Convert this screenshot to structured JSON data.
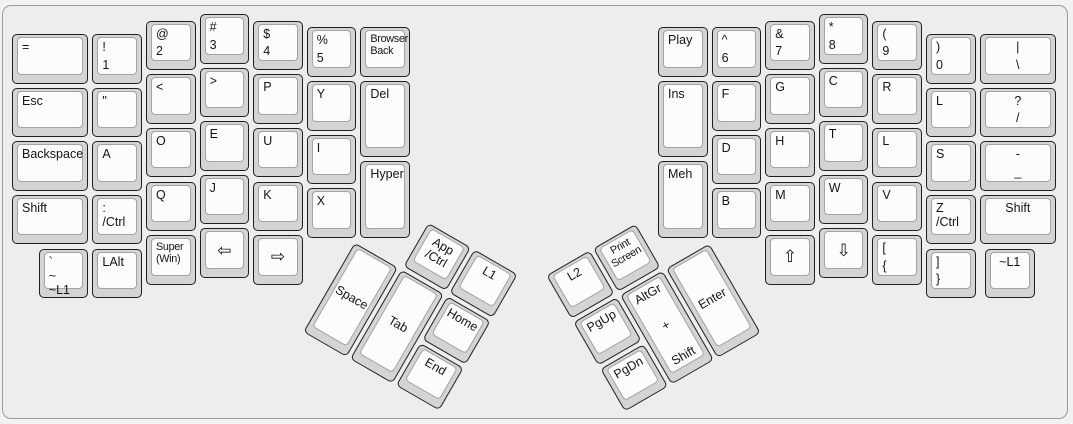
{
  "colors": {
    "page_bg": "#f2f2f2",
    "canvas_bg": "#ededed",
    "canvas_border": "#9b9b9b",
    "keycap_side": "#d4d4d4",
    "keycap_border": "#1f1f1f",
    "keycap_face": "#fcfcfc",
    "keycap_face_border": "#a3a3a3",
    "legend": "#141414"
  },
  "layout": {
    "unit": 53.6,
    "cap_inset": 2,
    "groups": {
      "left_main": {
        "origin_x": 10,
        "origin_y": 12,
        "rotation": 0,
        "keys": [
          {
            "name": "key-equals",
            "x": 0,
            "y": 0.375,
            "w": 1.5,
            "labels": [
              "="
            ]
          },
          {
            "name": "key-esc",
            "x": 0,
            "y": 1.375,
            "w": 1.5,
            "labels": [
              "Esc"
            ]
          },
          {
            "name": "key-backspace",
            "x": 0,
            "y": 2.375,
            "w": 1.5,
            "labels": [
              "Backspace"
            ]
          },
          {
            "name": "key-left-shift",
            "x": 0,
            "y": 3.375,
            "w": 1.5,
            "labels": [
              "Shift"
            ]
          },
          {
            "name": "key-1",
            "x": 1.5,
            "y": 0.375,
            "labels": [
              "!",
              "1"
            ],
            "v": "between"
          },
          {
            "name": "key-quote",
            "x": 1.5,
            "y": 1.375,
            "labels": [
              "\""
            ]
          },
          {
            "name": "key-a",
            "x": 1.5,
            "y": 2.375,
            "labels": [
              "A"
            ]
          },
          {
            "name": "key-colon-ctrl",
            "x": 1.5,
            "y": 3.375,
            "labels": [
              ":",
              "/Ctrl"
            ]
          },
          {
            "name": "key-2",
            "x": 2.5,
            "y": 0.125,
            "labels": [
              "@",
              "2"
            ],
            "v": "between"
          },
          {
            "name": "key-less-than",
            "x": 2.5,
            "y": 1.125,
            "labels": [
              "<"
            ]
          },
          {
            "name": "key-o",
            "x": 2.5,
            "y": 2.125,
            "labels": [
              "O"
            ]
          },
          {
            "name": "key-q",
            "x": 2.5,
            "y": 3.125,
            "labels": [
              "Q"
            ]
          },
          {
            "name": "key-3",
            "x": 3.5,
            "y": 0,
            "labels": [
              "#",
              "3"
            ],
            "v": "between"
          },
          {
            "name": "key-greater-than",
            "x": 3.5,
            "y": 1,
            "labels": [
              ">"
            ]
          },
          {
            "name": "key-e",
            "x": 3.5,
            "y": 2,
            "labels": [
              "E"
            ]
          },
          {
            "name": "key-j",
            "x": 3.5,
            "y": 3,
            "labels": [
              "J"
            ]
          },
          {
            "name": "key-4",
            "x": 4.5,
            "y": 0.125,
            "labels": [
              "$",
              "4"
            ],
            "v": "between"
          },
          {
            "name": "key-p",
            "x": 4.5,
            "y": 1.125,
            "labels": [
              "P"
            ]
          },
          {
            "name": "key-u",
            "x": 4.5,
            "y": 2.125,
            "labels": [
              "U"
            ]
          },
          {
            "name": "key-k",
            "x": 4.5,
            "y": 3.125,
            "labels": [
              "K"
            ]
          },
          {
            "name": "key-5",
            "x": 5.5,
            "y": 0.25,
            "labels": [
              "%",
              "5"
            ],
            "v": "between"
          },
          {
            "name": "key-y",
            "x": 5.5,
            "y": 1.25,
            "labels": [
              "Y"
            ]
          },
          {
            "name": "key-i",
            "x": 5.5,
            "y": 2.25,
            "labels": [
              "I"
            ]
          },
          {
            "name": "key-x",
            "x": 5.5,
            "y": 3.25,
            "labels": [
              "X"
            ]
          },
          {
            "name": "key-browser-back",
            "x": 6.5,
            "y": 0.25,
            "labels": [
              "Browser",
              "Back"
            ],
            "fs": "small"
          },
          {
            "name": "key-del",
            "x": 6.5,
            "y": 1.25,
            "h": 1.5,
            "labels": [
              "Del"
            ]
          },
          {
            "name": "key-hyper",
            "x": 6.5,
            "y": 2.75,
            "h": 1.5,
            "labels": [
              "Hyper"
            ]
          },
          {
            "name": "key-grave-l1",
            "x": 0.5,
            "y": 4.375,
            "labels": [
              "`",
              "~",
              "~L1"
            ],
            "v": "between"
          },
          {
            "name": "key-lalt",
            "x": 1.5,
            "y": 4.375,
            "labels": [
              "LAlt"
            ]
          },
          {
            "name": "key-super-win",
            "x": 2.5,
            "y": 4.125,
            "labels": [
              "Super",
              "(Win)"
            ],
            "fs": "small"
          },
          {
            "name": "key-arrow-left",
            "x": 3.5,
            "y": 4,
            "labels": [
              "⇦"
            ],
            "v": "mid",
            "a": "center",
            "fs": "big"
          },
          {
            "name": "key-arrow-right",
            "x": 4.5,
            "y": 4.125,
            "labels": [
              "⇨"
            ],
            "v": "mid",
            "a": "center",
            "fs": "big"
          }
        ]
      },
      "right_main": {
        "origin_x": 656,
        "origin_y": 12,
        "rotation": 0,
        "keys": [
          {
            "name": "key-play",
            "x": 0,
            "y": 0.25,
            "labels": [
              "Play"
            ]
          },
          {
            "name": "key-ins",
            "x": 0,
            "y": 1.25,
            "h": 1.5,
            "labels": [
              "Ins"
            ]
          },
          {
            "name": "key-meh",
            "x": 0,
            "y": 2.75,
            "h": 1.5,
            "labels": [
              "Meh"
            ]
          },
          {
            "name": "key-6",
            "x": 1,
            "y": 0.25,
            "labels": [
              "^",
              "6"
            ],
            "v": "between"
          },
          {
            "name": "key-f",
            "x": 1,
            "y": 1.25,
            "labels": [
              "F"
            ]
          },
          {
            "name": "key-d",
            "x": 1,
            "y": 2.25,
            "labels": [
              "D"
            ]
          },
          {
            "name": "key-b",
            "x": 1,
            "y": 3.25,
            "labels": [
              "B"
            ]
          },
          {
            "name": "key-7",
            "x": 2,
            "y": 0.125,
            "labels": [
              "&",
              "7"
            ],
            "v": "between"
          },
          {
            "name": "key-g",
            "x": 2,
            "y": 1.125,
            "labels": [
              "G"
            ]
          },
          {
            "name": "key-h",
            "x": 2,
            "y": 2.125,
            "labels": [
              "H"
            ]
          },
          {
            "name": "key-m",
            "x": 2,
            "y": 3.125,
            "labels": [
              "M"
            ]
          },
          {
            "name": "key-8",
            "x": 3,
            "y": 0,
            "labels": [
              "*",
              "8"
            ],
            "v": "between"
          },
          {
            "name": "key-c",
            "x": 3,
            "y": 1,
            "labels": [
              "C"
            ]
          },
          {
            "name": "key-t",
            "x": 3,
            "y": 2,
            "labels": [
              "T"
            ]
          },
          {
            "name": "key-w",
            "x": 3,
            "y": 3,
            "labels": [
              "W"
            ]
          },
          {
            "name": "key-9",
            "x": 4,
            "y": 0.125,
            "labels": [
              "(",
              "9"
            ],
            "v": "between"
          },
          {
            "name": "key-r",
            "x": 4,
            "y": 1.125,
            "labels": [
              "R"
            ]
          },
          {
            "name": "key-l-middle",
            "x": 4,
            "y": 2.125,
            "labels": [
              "L"
            ]
          },
          {
            "name": "key-v",
            "x": 4,
            "y": 3.125,
            "labels": [
              "V"
            ]
          },
          {
            "name": "key-0",
            "x": 5,
            "y": 0.375,
            "labels": [
              ")",
              "0"
            ],
            "v": "between"
          },
          {
            "name": "key-l-upper",
            "x": 5,
            "y": 1.375,
            "labels": [
              "L"
            ]
          },
          {
            "name": "key-s",
            "x": 5,
            "y": 2.375,
            "labels": [
              "S"
            ]
          },
          {
            "name": "key-z-ctrl",
            "x": 5,
            "y": 3.375,
            "labels": [
              "Z",
              "/Ctrl"
            ]
          },
          {
            "name": "key-pipe-backslash",
            "x": 6,
            "y": 0.375,
            "w": 1.5,
            "labels": [
              "|",
              "\\"
            ],
            "v": "between",
            "a": "center"
          },
          {
            "name": "key-question-slash",
            "x": 6,
            "y": 1.375,
            "w": 1.5,
            "labels": [
              "?",
              "/"
            ],
            "v": "between",
            "a": "center"
          },
          {
            "name": "key-minus-underscore",
            "x": 6,
            "y": 2.375,
            "w": 1.5,
            "labels": [
              "-",
              "_"
            ],
            "v": "between",
            "a": "center"
          },
          {
            "name": "key-right-shift",
            "x": 6,
            "y": 3.375,
            "w": 1.5,
            "labels": [
              "Shift"
            ],
            "a": "center"
          },
          {
            "name": "key-arrow-up",
            "x": 2,
            "y": 4.125,
            "labels": [
              "⇧"
            ],
            "v": "mid",
            "a": "center",
            "fs": "big"
          },
          {
            "name": "key-arrow-down",
            "x": 3,
            "y": 4,
            "labels": [
              "⇩"
            ],
            "v": "mid",
            "a": "center",
            "fs": "big"
          },
          {
            "name": "key-lbracket-brace",
            "x": 4,
            "y": 4.125,
            "labels": [
              "[",
              "{"
            ],
            "v": "between"
          },
          {
            "name": "key-rbracket-brace",
            "x": 5,
            "y": 4.375,
            "labels": [
              "]",
              "}"
            ],
            "v": "between"
          },
          {
            "name": "key-tilde-l1",
            "x": 6.1,
            "y": 4.375,
            "labels": [
              "~L1"
            ],
            "a": "center"
          }
        ]
      },
      "left_thumb": {
        "origin_x": 354,
        "origin_y": 240,
        "rotation": 30,
        "keys": [
          {
            "name": "key-app-ctrl",
            "x": 1,
            "y": -1,
            "labels": [
              "App",
              "/Ctrl"
            ],
            "a": "center"
          },
          {
            "name": "key-l1",
            "x": 2,
            "y": -1,
            "labels": [
              "L1"
            ],
            "a": "center"
          },
          {
            "name": "key-space",
            "x": 0,
            "y": 0,
            "h": 2,
            "labels": [
              "Space"
            ],
            "v": "mid",
            "a": "center"
          },
          {
            "name": "key-tab",
            "x": 1,
            "y": 0,
            "h": 2,
            "labels": [
              "Tab"
            ],
            "v": "mid",
            "a": "center"
          },
          {
            "name": "key-home",
            "x": 2,
            "y": 0,
            "labels": [
              "Home"
            ],
            "a": "center"
          },
          {
            "name": "key-end",
            "x": 2,
            "y": 1,
            "labels": [
              "End"
            ],
            "a": "center"
          }
        ]
      },
      "right_thumb": {
        "origin_x": 709.5,
        "origin_y": 241,
        "rotation": -30,
        "keys": [
          {
            "name": "key-l2",
            "x": -3,
            "y": -1,
            "labels": [
              "L2"
            ],
            "a": "center"
          },
          {
            "name": "key-print-screen",
            "x": -2,
            "y": -1,
            "labels": [
              "Print",
              "Screen"
            ],
            "a": "center",
            "fs": "small"
          },
          {
            "name": "key-pgup",
            "x": -3,
            "y": 0,
            "labels": [
              "PgUp"
            ],
            "a": "center"
          },
          {
            "name": "key-altgr-plus-shift",
            "x": -2,
            "y": 0,
            "h": 2,
            "labels": [
              "AltGr",
              "+",
              "Shift"
            ],
            "v": "between",
            "a": "center"
          },
          {
            "name": "key-enter",
            "x": -1,
            "y": 0,
            "h": 2,
            "labels": [
              "Enter"
            ],
            "v": "mid",
            "a": "center"
          },
          {
            "name": "key-pgdn",
            "x": -3,
            "y": 1,
            "labels": [
              "PgDn"
            ],
            "a": "center"
          }
        ]
      }
    }
  }
}
